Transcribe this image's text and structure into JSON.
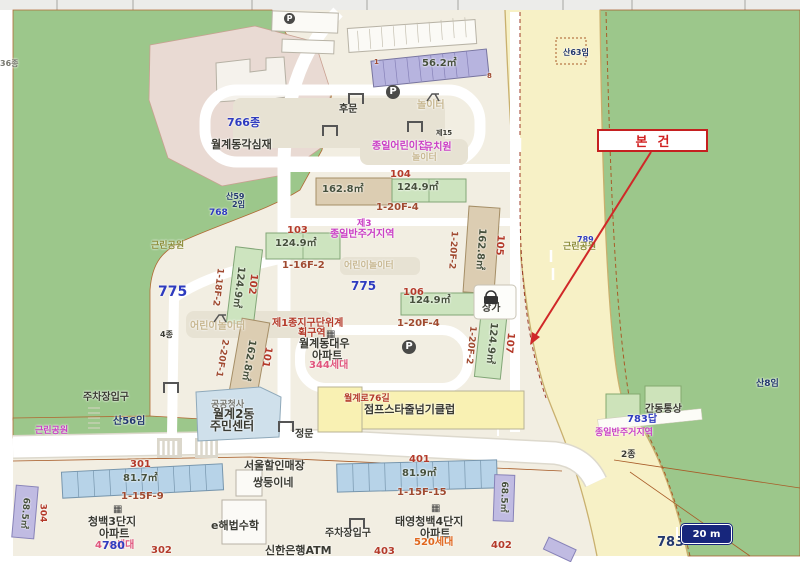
{
  "map": {
    "annotation": {
      "label": "본건"
    },
    "scale_bar": {
      "label": "20 m"
    },
    "icons": {
      "parking_glyph": "P",
      "apartment_glyph": "▦"
    },
    "labels": [
      {
        "t": "36종",
        "x": 0,
        "y": 60,
        "c": "gray",
        "s": 8
      },
      {
        "t": "766종",
        "x": 227,
        "y": 117,
        "c": "blue",
        "s": 11
      },
      {
        "t": "월계동각심재",
        "x": 211,
        "y": 139,
        "c": "dark",
        "s": 11
      },
      {
        "t": "후문",
        "x": 339,
        "y": 105,
        "c": "dark",
        "s": 10
      },
      {
        "t": "산59",
        "x": 226,
        "y": 193,
        "c": "navy",
        "s": 8
      },
      {
        "t": "2임",
        "x": 232,
        "y": 201,
        "c": "navy",
        "s": 8
      },
      {
        "t": "768",
        "x": 209,
        "y": 209,
        "c": "blue",
        "s": 9
      },
      {
        "t": "근린공원",
        "x": 151,
        "y": 242,
        "c": "olive",
        "s": 9
      },
      {
        "t": "775",
        "x": 158,
        "y": 285,
        "c": "blue",
        "s": 14
      },
      {
        "t": "775",
        "x": 351,
        "y": 280,
        "c": "blue",
        "s": 12
      },
      {
        "t": "어린이놀이터",
        "x": 344,
        "y": 262,
        "c": "tan",
        "s": 9
      },
      {
        "t": "어린이놀이터",
        "x": 190,
        "y": 322,
        "c": "tan",
        "s": 10
      },
      {
        "t": "4종",
        "x": 160,
        "y": 331,
        "c": "dark",
        "s": 8
      },
      {
        "t": "산56임",
        "x": 113,
        "y": 417,
        "c": "navy",
        "s": 10
      },
      {
        "t": "제3",
        "x": 357,
        "y": 220,
        "c": "mag",
        "s": 9
      },
      {
        "t": "종일반주거지역",
        "x": 330,
        "y": 230,
        "c": "mag",
        "s": 10
      },
      {
        "t": "제15",
        "x": 436,
        "y": 130,
        "c": "dark",
        "s": 7
      },
      {
        "t": "종일어린이집",
        "x": 372,
        "y": 142,
        "c": "mag",
        "s": 10
      },
      {
        "t": "유치원",
        "x": 424,
        "y": 143,
        "c": "mag",
        "s": 10
      },
      {
        "t": "놀이터",
        "x": 412,
        "y": 154,
        "c": "tan",
        "s": 9
      },
      {
        "t": "놀이터",
        "x": 417,
        "y": 101,
        "c": "tan",
        "s": 10
      },
      {
        "t": "56.2㎡",
        "x": 422,
        "y": 59,
        "c": "size",
        "s": 10
      },
      {
        "t": "1",
        "x": 374,
        "y": 59,
        "c": "dred",
        "s": 7
      },
      {
        "t": "8",
        "x": 487,
        "y": 73,
        "c": "dred",
        "s": 7
      },
      {
        "t": "104",
        "x": 390,
        "y": 170,
        "c": "red",
        "s": 10
      },
      {
        "t": "124.9㎡",
        "x": 397,
        "y": 183,
        "c": "size",
        "s": 10
      },
      {
        "t": "1-20F-4",
        "x": 376,
        "y": 203,
        "c": "dred",
        "s": 10
      },
      {
        "t": "162.8㎡",
        "x": 322,
        "y": 185,
        "c": "size",
        "s": 10
      },
      {
        "t": "103",
        "x": 287,
        "y": 226,
        "c": "red",
        "s": 10
      },
      {
        "t": "124.9㎡",
        "x": 275,
        "y": 239,
        "c": "size",
        "s": 10
      },
      {
        "t": "1-16F-2",
        "x": 282,
        "y": 261,
        "c": "dred",
        "s": 10
      },
      {
        "t": "102",
        "x": 252,
        "y": 284,
        "c": "red",
        "s": 10,
        "r": 97
      },
      {
        "t": "124.9㎡",
        "x": 238,
        "y": 287,
        "c": "size",
        "s": 10,
        "r": 97
      },
      {
        "t": "1-18F-2",
        "x": 217,
        "y": 287,
        "c": "dred",
        "s": 9,
        "r": 97
      },
      {
        "t": "101",
        "x": 266,
        "y": 357,
        "c": "red",
        "s": 10,
        "r": 100
      },
      {
        "t": "162.8㎡",
        "x": 248,
        "y": 360,
        "c": "size",
        "s": 10,
        "r": 100
      },
      {
        "t": "2-20F-1",
        "x": 221,
        "y": 358,
        "c": "dred",
        "s": 9,
        "r": 100
      },
      {
        "t": "105",
        "x": 499,
        "y": 245,
        "c": "red",
        "s": 10,
        "r": 94
      },
      {
        "t": "162.8㎡",
        "x": 480,
        "y": 249,
        "c": "size",
        "s": 10,
        "r": 94
      },
      {
        "t": "1-20F-2",
        "x": 452,
        "y": 250,
        "c": "dred",
        "s": 9,
        "r": 94
      },
      {
        "t": "106",
        "x": 403,
        "y": 288,
        "c": "red",
        "s": 10
      },
      {
        "t": "124.9㎡",
        "x": 409,
        "y": 296,
        "c": "size",
        "s": 10
      },
      {
        "t": "1-20F-4",
        "x": 397,
        "y": 319,
        "c": "dred",
        "s": 10
      },
      {
        "t": "107",
        "x": 509,
        "y": 343,
        "c": "red",
        "s": 10,
        "r": 96
      },
      {
        "t": "124.9㎡",
        "x": 491,
        "y": 343,
        "c": "size",
        "s": 10,
        "r": 96
      },
      {
        "t": "1-20F-2",
        "x": 470,
        "y": 345,
        "c": "dred",
        "s": 9,
        "r": 96
      },
      {
        "t": "상가",
        "x": 482,
        "y": 304,
        "c": "dark",
        "s": 10
      },
      {
        "t": "제1종지구단위계",
        "x": 272,
        "y": 319,
        "c": "red",
        "s": 10
      },
      {
        "t": "획구역",
        "x": 298,
        "y": 329,
        "c": "red",
        "s": 10
      },
      {
        "t": "월계동대우",
        "x": 299,
        "y": 338,
        "c": "dark",
        "s": 11
      },
      {
        "t": "아파트",
        "x": 312,
        "y": 350,
        "c": "dark",
        "s": 11
      },
      {
        "t": "344세대",
        "x": 309,
        "y": 361,
        "c": "pink",
        "s": 10
      },
      {
        "t": "월계로76길",
        "x": 344,
        "y": 395,
        "c": "red",
        "s": 9
      },
      {
        "t": "점프스타줄넘기클럽",
        "x": 364,
        "y": 404,
        "c": "dark",
        "s": 11
      },
      {
        "t": "공공청사",
        "x": 211,
        "y": 401,
        "c": "gray",
        "s": 9
      },
      {
        "t": "월계2동",
        "x": 213,
        "y": 408,
        "c": "dark",
        "s": 12
      },
      {
        "t": "주민센터",
        "x": 210,
        "y": 420,
        "c": "dark",
        "s": 12
      },
      {
        "t": "정문",
        "x": 295,
        "y": 430,
        "c": "dark",
        "s": 10
      },
      {
        "t": "주차장입구",
        "x": 83,
        "y": 393,
        "c": "dark",
        "s": 10
      },
      {
        "t": "근린공원",
        "x": 35,
        "y": 427,
        "c": "mag",
        "s": 9
      },
      {
        "t": "301",
        "x": 130,
        "y": 460,
        "c": "red",
        "s": 10
      },
      {
        "t": "81.7㎡",
        "x": 123,
        "y": 474,
        "c": "size",
        "s": 10
      },
      {
        "t": "1-15F-9",
        "x": 121,
        "y": 492,
        "c": "dred",
        "s": 10
      },
      {
        "t": "청백3단지",
        "x": 88,
        "y": 516,
        "c": "dark",
        "s": 11
      },
      {
        "t": "아파트",
        "x": 99,
        "y": 528,
        "c": "dark",
        "s": 11
      },
      {
        "t": "470세대",
        "x": 95,
        "y": 541,
        "c": "pink",
        "s": 10
      },
      {
        "t": "780",
        "x": 102,
        "y": 540,
        "c": "blue",
        "s": 11
      },
      {
        "t": "302",
        "x": 151,
        "y": 546,
        "c": "red",
        "s": 10
      },
      {
        "t": "304",
        "x": 42,
        "y": 513,
        "c": "red",
        "s": 9,
        "r": 90
      },
      {
        "t": "68.5㎡",
        "x": 24,
        "y": 513,
        "c": "size",
        "s": 9,
        "r": 95
      },
      {
        "t": "e해법수학",
        "x": 211,
        "y": 520,
        "c": "dark",
        "s": 11
      },
      {
        "t": "서울할인매장",
        "x": 244,
        "y": 460,
        "c": "dark",
        "s": 11
      },
      {
        "t": "쌍둥이네",
        "x": 253,
        "y": 477,
        "c": "dark",
        "s": 11
      },
      {
        "t": "신한은행ATM",
        "x": 265,
        "y": 545,
        "c": "dark",
        "s": 11
      },
      {
        "t": "401",
        "x": 409,
        "y": 455,
        "c": "red",
        "s": 10
      },
      {
        "t": "81.9㎡",
        "x": 402,
        "y": 469,
        "c": "size",
        "s": 10
      },
      {
        "t": "1-15F-15",
        "x": 397,
        "y": 488,
        "c": "dred",
        "s": 10
      },
      {
        "t": "태영청백4단지",
        "x": 395,
        "y": 516,
        "c": "dark",
        "s": 11
      },
      {
        "t": "아파트",
        "x": 420,
        "y": 528,
        "c": "dark",
        "s": 11
      },
      {
        "t": "520세대",
        "x": 414,
        "y": 538,
        "c": "org",
        "s": 10
      },
      {
        "t": "403",
        "x": 374,
        "y": 547,
        "c": "red",
        "s": 10
      },
      {
        "t": "402",
        "x": 491,
        "y": 541,
        "c": "red",
        "s": 10
      },
      {
        "t": "68.5㎡",
        "x": 503,
        "y": 497,
        "c": "size",
        "s": 9,
        "r": 92
      },
      {
        "t": "주차장입구",
        "x": 325,
        "y": 529,
        "c": "dark",
        "s": 10
      },
      {
        "t": "산63임",
        "x": 563,
        "y": 49,
        "c": "navy",
        "s": 8
      },
      {
        "t": "789",
        "x": 577,
        "y": 236,
        "c": "blue",
        "s": 8
      },
      {
        "t": "근린공원",
        "x": 563,
        "y": 243,
        "c": "olive",
        "s": 9
      },
      {
        "t": "간동통상",
        "x": 645,
        "y": 405,
        "c": "dark",
        "s": 10
      },
      {
        "t": "783답",
        "x": 627,
        "y": 415,
        "c": "blue",
        "s": 10
      },
      {
        "t": "종일반주거지역",
        "x": 595,
        "y": 429,
        "c": "mag",
        "s": 9
      },
      {
        "t": "2종",
        "x": 621,
        "y": 451,
        "c": "dark",
        "s": 9
      },
      {
        "t": "산8임",
        "x": 756,
        "y": 380,
        "c": "navy",
        "s": 9
      },
      {
        "t": "783",
        "x": 657,
        "y": 536,
        "c": "navy",
        "s": 13
      }
    ]
  }
}
